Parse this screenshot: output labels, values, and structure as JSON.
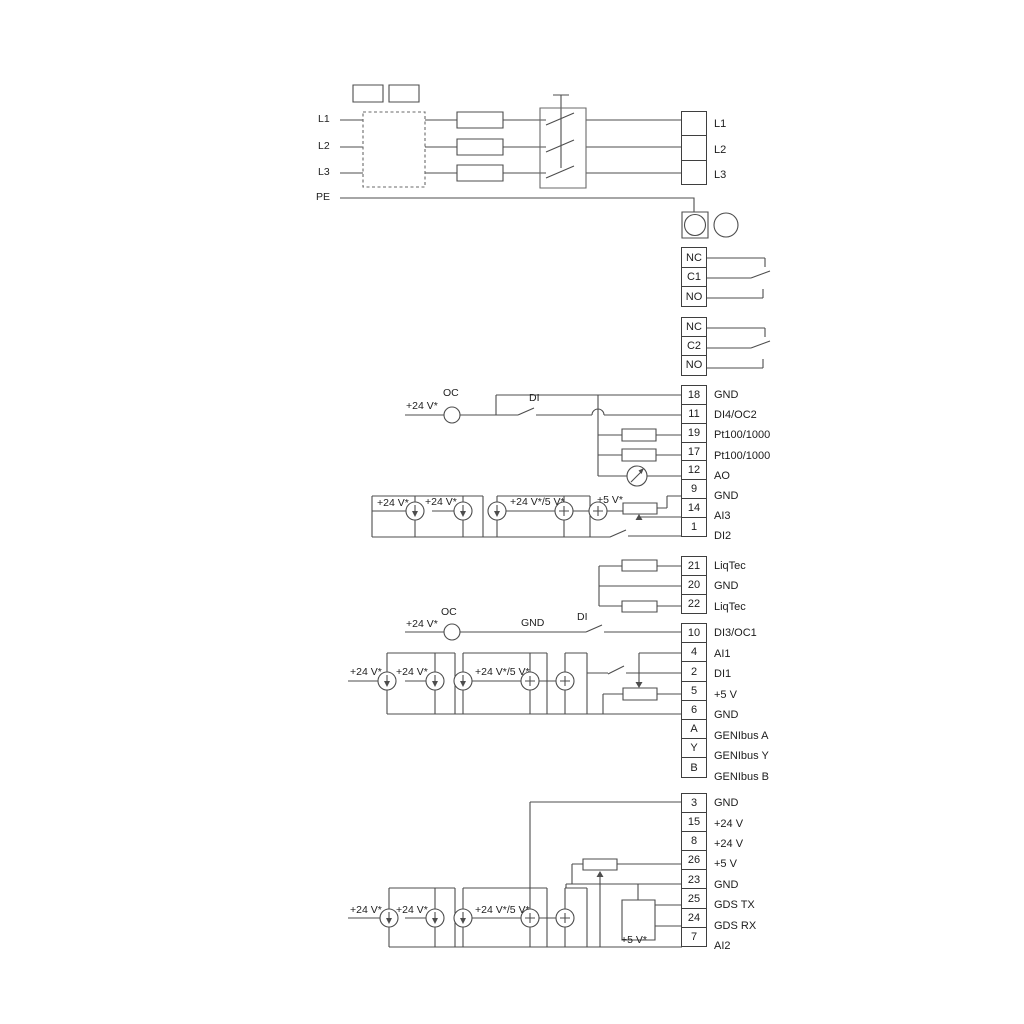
{
  "diagram": {
    "kind": "electrical wiring diagram",
    "wire_color": "#4d4d4d"
  },
  "terminal_strips": [
    {
      "name": "mains-output-terminals",
      "x": 681,
      "y": 111,
      "w": 26,
      "h": 25.7,
      "cells": [
        {
          "num": "",
          "label": "L1"
        },
        {
          "num": "",
          "label": "L2"
        },
        {
          "num": "",
          "label": "L3"
        }
      ]
    },
    {
      "name": "relay-1-terminals",
      "x": 681,
      "y": 247,
      "w": 26,
      "h": 21,
      "cells": [
        {
          "num": "NC",
          "label": ""
        },
        {
          "num": "C1",
          "label": ""
        },
        {
          "num": "NO",
          "label": ""
        }
      ]
    },
    {
      "name": "relay-2-terminals",
      "x": 681,
      "y": 317,
      "w": 26,
      "h": 20.4,
      "cells": [
        {
          "num": "NC",
          "label": ""
        },
        {
          "num": "C2",
          "label": ""
        },
        {
          "num": "NO",
          "label": ""
        }
      ]
    },
    {
      "name": "io-strip-1",
      "x": 681,
      "y": 385,
      "w": 26,
      "h": 20.15,
      "cells": [
        {
          "num": "18",
          "label": "GND"
        },
        {
          "num": "11",
          "label": "DI4/OC2"
        },
        {
          "num": "19",
          "label": "Pt100/1000"
        },
        {
          "num": "17",
          "label": "Pt100/1000"
        },
        {
          "num": "12",
          "label": "AO"
        },
        {
          "num": "9",
          "label": "GND"
        },
        {
          "num": "14",
          "label": "AI3"
        },
        {
          "num": "1",
          "label": "DI2"
        }
      ]
    },
    {
      "name": "liqtec-strip",
      "x": 681,
      "y": 556,
      "w": 26,
      "h": 20.3,
      "cells": [
        {
          "num": "21",
          "label": "LiqTec"
        },
        {
          "num": "20",
          "label": "GND"
        },
        {
          "num": "22",
          "label": "LiqTec"
        }
      ]
    },
    {
      "name": "io-strip-2",
      "x": 681,
      "y": 623,
      "w": 26,
      "h": 20.5,
      "cells": [
        {
          "num": "10",
          "label": "DI3/OC1"
        },
        {
          "num": "4",
          "label": "AI1"
        },
        {
          "num": "2",
          "label": "DI1"
        },
        {
          "num": "5",
          "label": "+5 V"
        },
        {
          "num": "6",
          "label": "GND"
        },
        {
          "num": "A",
          "label": "GENIbus A"
        },
        {
          "num": "Y",
          "label": "GENIbus Y"
        },
        {
          "num": "B",
          "label": "GENIbus B"
        }
      ]
    },
    {
      "name": "io-strip-3",
      "x": 681,
      "y": 793,
      "w": 26,
      "h": 20.4,
      "cells": [
        {
          "num": "3",
          "label": "GND"
        },
        {
          "num": "15",
          "label": "+24 V"
        },
        {
          "num": "8",
          "label": "+24 V"
        },
        {
          "num": "26",
          "label": "+5 V"
        },
        {
          "num": "23",
          "label": "GND"
        },
        {
          "num": "25",
          "label": "GDS TX"
        },
        {
          "num": "24",
          "label": "GDS RX"
        },
        {
          "num": "7",
          "label": "AI2"
        }
      ]
    }
  ],
  "annotations": [
    {
      "text": "L1",
      "x": 318,
      "y": 113
    },
    {
      "text": "L2",
      "x": 318,
      "y": 140
    },
    {
      "text": "L3",
      "x": 318,
      "y": 166
    },
    {
      "text": "PE",
      "x": 316,
      "y": 191
    },
    {
      "text": "+24 V*",
      "x": 406,
      "y": 400
    },
    {
      "text": "OC",
      "x": 443,
      "y": 387
    },
    {
      "text": "DI",
      "x": 529,
      "y": 392
    },
    {
      "text": "+24 V*",
      "x": 377,
      "y": 497
    },
    {
      "text": "+24 V*",
      "x": 425,
      "y": 496
    },
    {
      "text": "+24 V*/5 V*",
      "x": 510,
      "y": 496
    },
    {
      "text": "+5 V*",
      "x": 597,
      "y": 494
    },
    {
      "text": "+24 V*",
      "x": 406,
      "y": 618
    },
    {
      "text": "OC",
      "x": 441,
      "y": 606
    },
    {
      "text": "GND",
      "x": 521,
      "y": 617
    },
    {
      "text": "DI",
      "x": 577,
      "y": 611
    },
    {
      "text": "+24 V*",
      "x": 350,
      "y": 666
    },
    {
      "text": "+24 V*",
      "x": 396,
      "y": 666
    },
    {
      "text": "+24 V*/5 V*",
      "x": 475,
      "y": 666
    },
    {
      "text": "+24 V*",
      "x": 350,
      "y": 904
    },
    {
      "text": "+24 V*",
      "x": 396,
      "y": 904
    },
    {
      "text": "+24 V*/5 V*",
      "x": 475,
      "y": 904
    },
    {
      "text": "+5 V*",
      "x": 621,
      "y": 934
    }
  ]
}
